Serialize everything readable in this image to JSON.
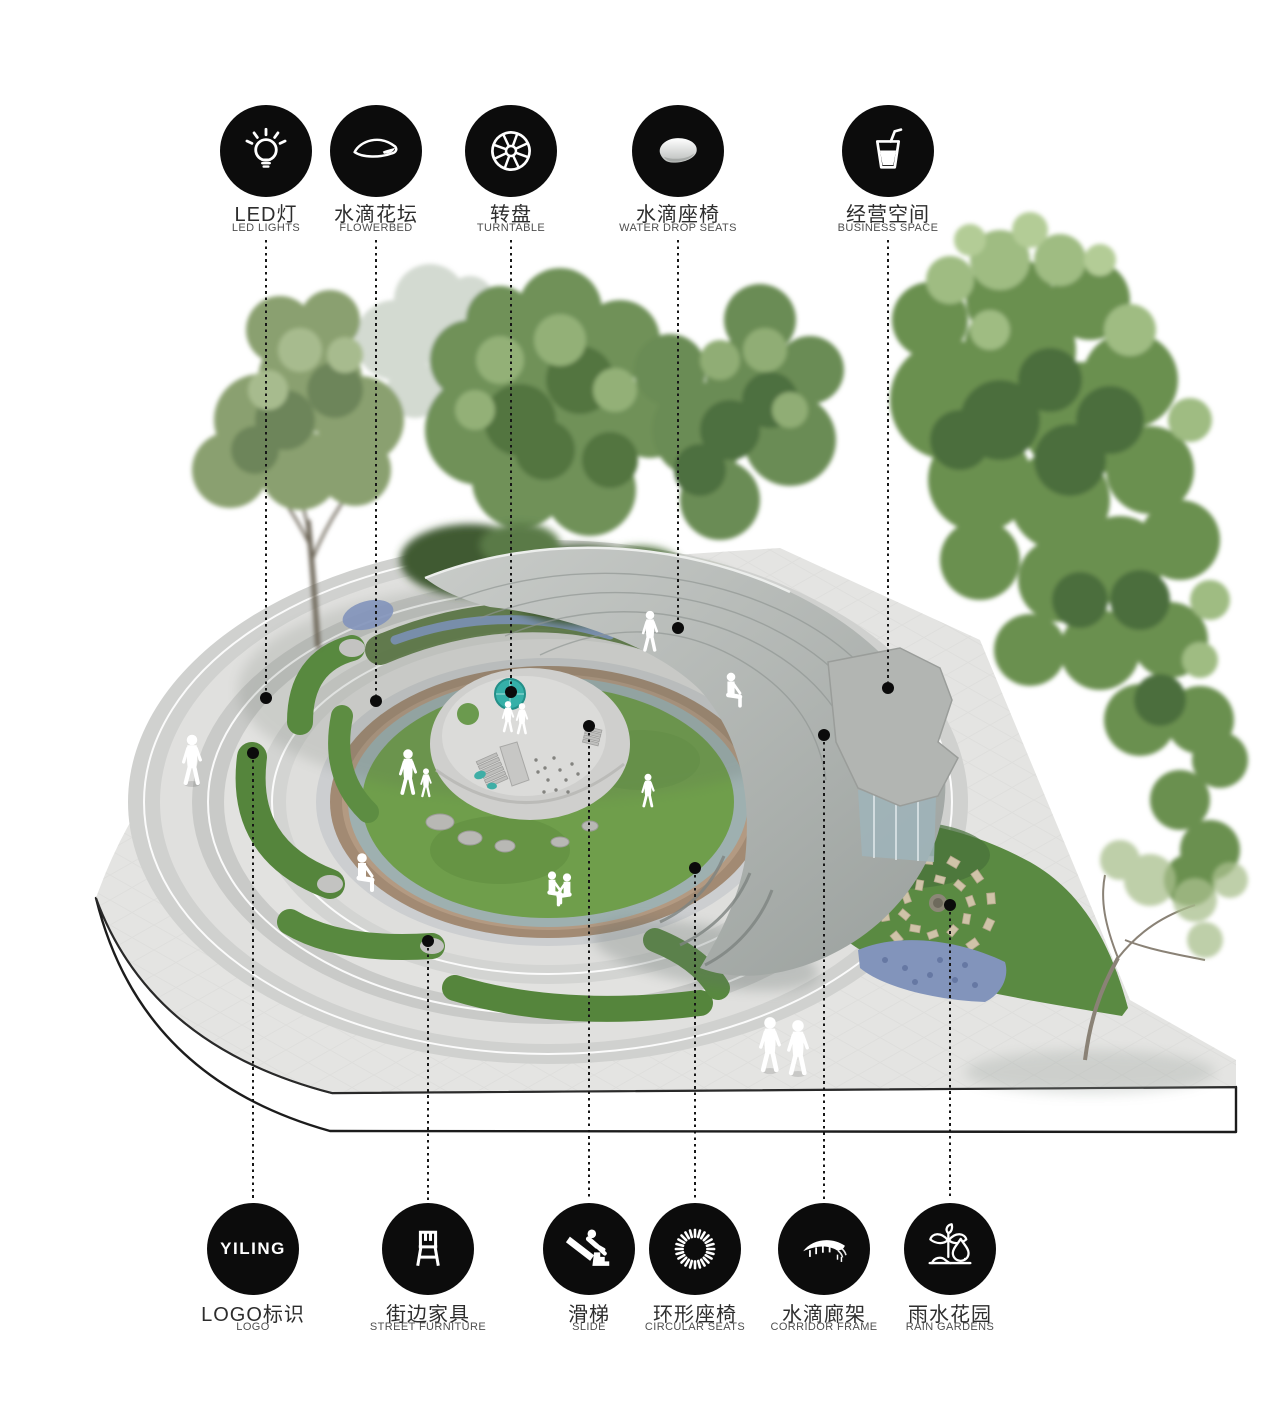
{
  "legend_top": [
    {
      "zh": "LED灯",
      "en": "LED LIGHTS",
      "icon": "led-lights-icon"
    },
    {
      "zh": "水滴花坛",
      "en": "FLOWERBED",
      "icon": "flowerbed-leaf-icon"
    },
    {
      "zh": "转盘",
      "en": "TURNTABLE",
      "icon": "turntable-wheel-icon"
    },
    {
      "zh": "水滴座椅",
      "en": "WATER DROP SEATS",
      "icon": "water-drop-seat-icon"
    },
    {
      "zh": "经营空间",
      "en": "BUSINESS SPACE",
      "icon": "drink-cup-icon"
    }
  ],
  "legend_bottom": [
    {
      "zh": "LOGO标识",
      "en": "LOGO",
      "icon": "yiling-logo-icon",
      "logo_text": "YILING"
    },
    {
      "zh": "街边家具",
      "en": "STREET FURNITURE",
      "icon": "chair-icon"
    },
    {
      "zh": "滑梯",
      "en": "SLIDE",
      "icon": "slide-icon"
    },
    {
      "zh": "环形座椅",
      "en": "CIRCULAR SEATS",
      "icon": "circular-seats-ring-icon"
    },
    {
      "zh": "水滴廊架",
      "en": "CORRIDOR FRAME",
      "icon": "corridor-canopy-icon"
    },
    {
      "zh": "雨水花园",
      "en": "RAIN GARDENS",
      "icon": "rain-garden-plant-drop-icon"
    }
  ],
  "colors": {
    "badge_bg": "#0c0c0c",
    "label_zh": "#2d2d2d",
    "label_en": "#4e4e4e",
    "leader_line": "#161616",
    "paving": "#e4e4e2",
    "terrace_light": "#e0e0de",
    "terrace_mid": "#d0d1cf",
    "terrace_dark": "#c9cac8",
    "tan_ring": "#a28a73",
    "lawn_green": "#6f9e4b",
    "planter_green": "#58893f",
    "canopy_grey": "#b3b7b4",
    "turntable_teal": "#35b0a8",
    "tree_dark": "#4b6e3c",
    "tree_mid": "#6b9050",
    "tree_light": "#9fbc82",
    "flower_blue": "#8294bb"
  }
}
